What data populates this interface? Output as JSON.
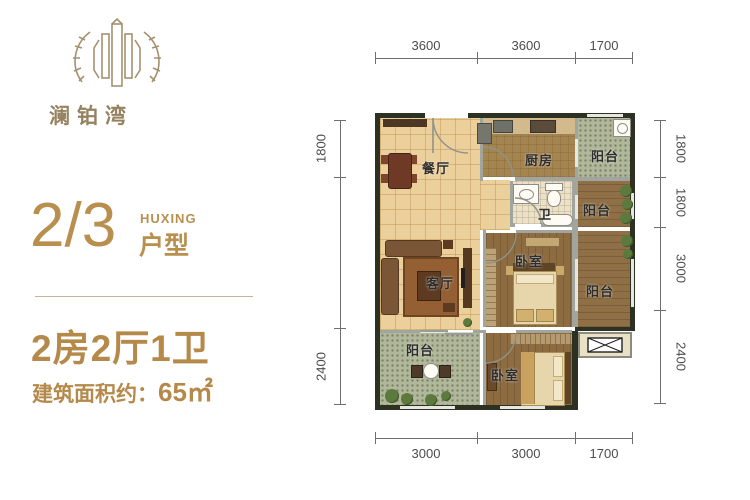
{
  "brand": {
    "name": "澜铂湾"
  },
  "unit": {
    "number": "2/3",
    "huxing_en": "HUXING",
    "huxing_cn": "户型",
    "layout": "2房2厅1卫",
    "area_label": "建筑面积约：",
    "area_value": "65㎡"
  },
  "floor_plan": {
    "rooms": {
      "dining": {
        "label": "餐厅"
      },
      "kitchen": {
        "label": "厨房"
      },
      "balcony_top": {
        "label": "阳台"
      },
      "bath": {
        "label": "卫"
      },
      "balcony_mid": {
        "label": "阳台"
      },
      "living": {
        "label": "客厅"
      },
      "bedroom_main": {
        "label": "卧室"
      },
      "balcony_right": {
        "label": "阳台"
      },
      "balcony_bottom": {
        "label": "阳台"
      },
      "bedroom_second": {
        "label": "卧室"
      }
    },
    "dimensions": {
      "top": [
        "3600",
        "3600",
        "1700"
      ],
      "bottom": [
        "3000",
        "3000",
        "1700"
      ],
      "left": [
        "1800",
        "2400"
      ],
      "right": [
        "1800",
        "1800",
        "3000",
        "2400"
      ]
    }
  },
  "colors": {
    "accent_gold": "#b5894a",
    "logo_brown": "#a5916f",
    "exterior_wall": "#2c3122",
    "interior_wall": "#a2a59e",
    "tile_floor": "#ecd09c",
    "wood_floor": "#8d6c42",
    "balcony_green": "#b0b79b",
    "dimension_text": "#4c4c4c"
  }
}
